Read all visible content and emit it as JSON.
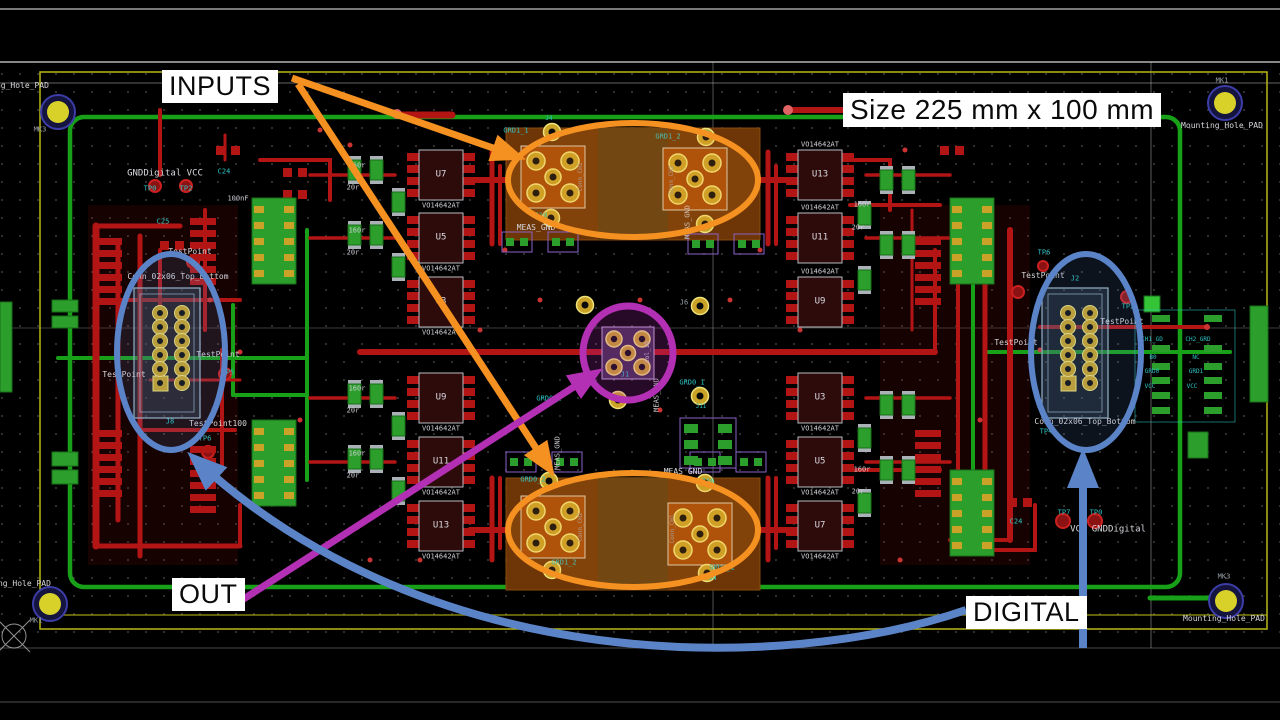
{
  "annotations": {
    "inputs": "INPUTS",
    "out": "OUT",
    "digital": "DIGITAL",
    "size": "Size 225 mm x 100 mm"
  },
  "colors": {
    "board_outline": "#b9b918",
    "copper_top": "#b31414",
    "copper_bottom": "#18a018",
    "copper_zone": "#6e3606",
    "pad_gold": "#c9a227",
    "highlight_orange": "#f59120",
    "highlight_magenta": "#b32fb3",
    "highlight_blue": "#5b84c8",
    "silk_white": "#d8d8d8",
    "net_teal": "#2ec4c4"
  },
  "pcb": {
    "ic_value": "VO14642AT",
    "ics_left_top": [
      "U7",
      "U5",
      "U3"
    ],
    "ics_left_bottom": [
      "U9",
      "U11",
      "U13"
    ],
    "ics_right_top": [
      "U13",
      "U11",
      "U9"
    ],
    "ics_right_bottom": [
      "U3",
      "U5",
      "U7"
    ],
    "connector_side": "Conn_02x06_Top_Bottom",
    "mounting_hole": "Mounting_Hole_PAD",
    "conn_ch1": "Conn_CH1",
    "conn_ch2": "Conn_CH2",
    "col_1d": "Col_1D",
    "testpoint": "TestPoint",
    "testpoint100": "TestPoint100",
    "refs": {
      "mk1": "MK1",
      "mk3": "MK3",
      "j1": "J1",
      "j2": "J2",
      "j4": "J4",
      "j5": "J5",
      "j6": "J6",
      "j8": "J8",
      "j10": "J10",
      "j11": "J11"
    },
    "nets": {
      "grd1_1": "GRD1_1",
      "grd1_2": "GRD1_2",
      "grd0_1": "GRD0_1",
      "grd0_2": "GRD0_2",
      "meas_gnd": "MEAS_GND",
      "gnd_digital_vcc": "GNDDigital VCC",
      "vcc_gnd_digital": "VCC GNDDigital"
    },
    "tps": {
      "tp0": "TP0",
      "tp2": "TP2",
      "tp4": "TP4",
      "tp5": "TP5",
      "tp6": "TP6",
      "tp7": "TP7"
    },
    "caps": {
      "c24": "C24",
      "c25": "C25",
      "value_100nf": "100nF"
    },
    "res": {
      "r160": "160r",
      "r20": "20r"
    },
    "io_table": {
      "rows": [
        [
          "CH1_GD",
          "CH2_GRD"
        ],
        [
          "B0",
          "NC"
        ],
        [
          "GRD0",
          "GRD1"
        ],
        [
          "VCC",
          "VCC"
        ]
      ]
    }
  }
}
